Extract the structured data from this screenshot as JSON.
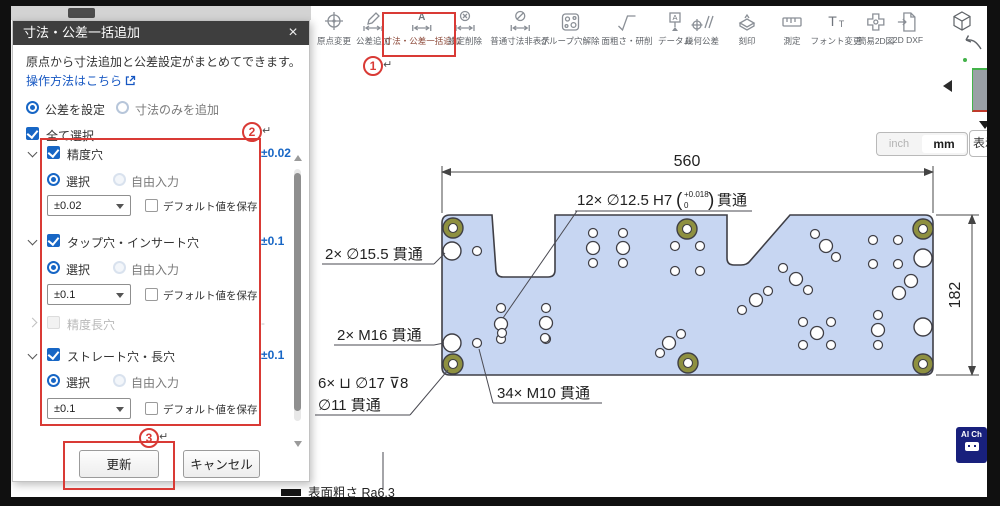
{
  "colors": {
    "accent_blue": "#1766c5",
    "annotation_red": "#d93a35",
    "plate_fill": "#c7d6f2",
    "olive_ring": "#8e9040",
    "badge_navy": "#18207c",
    "link_blue": "#1657c2"
  },
  "toolbar": {
    "items": [
      {
        "label": "原点変更",
        "icon": "origin-change-icon"
      },
      {
        "label": "公差追加",
        "icon": "tolerance-add-icon"
      },
      {
        "label": "寸法・公差一括追加",
        "icon": "dimension-tolerance-batch-add-icon",
        "glyph": "A",
        "selected": true
      },
      {
        "label": "設定削除",
        "icon": "settings-delete-icon"
      },
      {
        "label": "普通寸法非表示",
        "icon": "hide-normal-dimensions-icon"
      },
      {
        "label": "グループ穴解除",
        "icon": "group-hole-release-icon"
      },
      {
        "label": "面粗さ・研削",
        "icon": "surface-roughness-icon"
      },
      {
        "label": "データム",
        "icon": "datum-icon",
        "glyph": "A"
      },
      {
        "label": "幾何公差",
        "icon": "geometric-tolerance-icon"
      },
      {
        "label": "刻印",
        "icon": "engraving-icon"
      },
      {
        "label": "測定",
        "icon": "measure-icon"
      },
      {
        "label": "フォント変更",
        "icon": "font-change-icon",
        "glyph_big": "T",
        "glyph_small": "T"
      },
      {
        "label": "簡易2D図",
        "icon": "simple-2d-icon"
      },
      {
        "label": "2D DXF",
        "icon": "dxf-icon"
      }
    ]
  },
  "dialog": {
    "title": "寸法・公差一括追加",
    "close_glyph": "×",
    "description": "原点から寸法追加と公差設定がまとめてできます。",
    "help_link_label": "操作方法はこちら",
    "mode_option_1": "公差を設定",
    "mode_option_2": "寸法のみを追加",
    "select_all_label": "全て選択",
    "sections": [
      {
        "label": "精度穴",
        "value": "±0.02",
        "select_label": "選択",
        "free_input_label": "自由入力",
        "dropdown_value": "±0.02",
        "save_default_label": "デフォルト値を保存"
      },
      {
        "label": "タップ穴・インサート穴",
        "value": "±0.1",
        "select_label": "選択",
        "free_input_label": "自由入力",
        "dropdown_value": "±0.1",
        "save_default_label": "デフォルト値を保存"
      },
      {
        "label": "精度長穴",
        "value": "-"
      },
      {
        "label": "ストレート穴・長穴",
        "value": "±0.1",
        "select_label": "選択",
        "free_input_label": "自由入力",
        "dropdown_value": "±0.1",
        "save_default_label": "デフォルト値を保存"
      }
    ],
    "update_label": "更新",
    "cancel_label": "キャンセル"
  },
  "annotations": {
    "n1": "1",
    "n2": "2",
    "n3": "3",
    "return_mark": "↵"
  },
  "unit_toggle": {
    "inch_label": "inch",
    "mm_label": "mm"
  },
  "display_button_label": "表示",
  "ai_badge_label": "AI Ch",
  "drawing": {
    "width_dim": "560",
    "height_dim": "182",
    "label_h7_prefix": "12× ∅12.5 H7",
    "paren_open": "(",
    "label_h7_tol_upper": "+0.018",
    "label_h7_tol_lower": "0",
    "paren_close": ")",
    "label_h7_suffix": "貫通",
    "label_d155": "2× ∅15.5 貫通",
    "label_m16": "2× M16 貫通",
    "label_cbore_line1": "6× ⊔ ∅17 ⊽8",
    "label_cbore_line2": "∅11 貫通",
    "label_m10": "34× M10 貫通",
    "surface_note": "表面粗さ Ra6.3",
    "holes": {
      "small": [
        [
          477,
          251
        ],
        [
          477,
          343
        ],
        [
          501,
          308
        ],
        [
          501,
          339
        ],
        [
          546,
          308
        ],
        [
          546,
          339
        ],
        [
          593,
          233
        ],
        [
          623,
          233
        ],
        [
          593,
          263
        ],
        [
          623,
          263
        ],
        [
          675,
          246
        ],
        [
          700,
          246
        ],
        [
          675,
          271
        ],
        [
          700,
          271
        ],
        [
          815,
          234
        ],
        [
          836,
          257
        ],
        [
          783,
          268
        ],
        [
          808,
          290
        ],
        [
          742,
          310
        ],
        [
          768,
          291
        ],
        [
          660,
          353
        ],
        [
          681,
          334
        ],
        [
          502,
          333
        ],
        [
          545,
          338
        ],
        [
          873,
          240
        ],
        [
          898,
          240
        ],
        [
          873,
          264
        ],
        [
          898,
          264
        ],
        [
          803,
          322
        ],
        [
          831,
          322
        ],
        [
          803,
          345
        ],
        [
          831,
          345
        ],
        [
          878,
          315
        ],
        [
          878,
          345
        ]
      ],
      "medium": [
        [
          501,
          324
        ],
        [
          546,
          323
        ],
        [
          593,
          248
        ],
        [
          623,
          248
        ],
        [
          826,
          246
        ],
        [
          796,
          279
        ],
        [
          756,
          300
        ],
        [
          669,
          343
        ],
        [
          817,
          333
        ],
        [
          878,
          330
        ],
        [
          911,
          281
        ],
        [
          899,
          293
        ]
      ],
      "large": [
        [
          452,
          251
        ],
        [
          923,
          258
        ],
        [
          452,
          343
        ],
        [
          923,
          327
        ]
      ],
      "olive": [
        [
          453,
          228
        ],
        [
          453,
          364
        ],
        [
          687,
          229
        ],
        [
          688,
          363
        ],
        [
          923,
          229
        ],
        [
          923,
          364
        ]
      ]
    }
  }
}
